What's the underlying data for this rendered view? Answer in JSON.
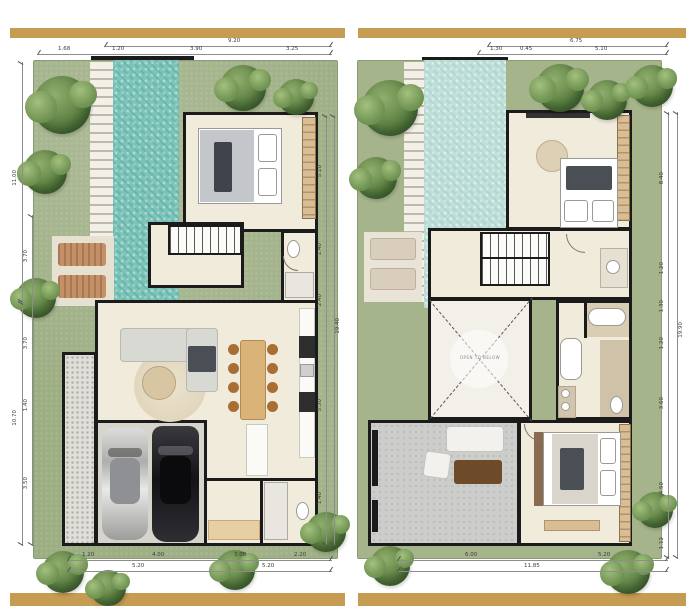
{
  "meta": {
    "description": "Two-storey villa floor plans with lap pool — ground floor (left) and upper floor (right)"
  },
  "colors": {
    "accent_gold": "#c69b52",
    "pool": "#7cc4b9",
    "pool_below": "#bfe0d9",
    "lawn": "#9dae83",
    "wall": "#1b1b1b",
    "floor": "#f1ebdc"
  },
  "labels": {
    "void": "OPEN TO BELOW"
  },
  "plans": [
    {
      "name": "Ground Floor",
      "dims": {
        "top": {
          "overall": "9.20",
          "segments": [
            "1.68",
            "1.20",
            "3.90",
            "3.25"
          ]
        },
        "left": {
          "overall_upper": "11.00",
          "overall_lower": "10.70",
          "segments": [
            "3.70",
            "3.70",
            "1.40",
            "3.50"
          ]
        },
        "right": {
          "overall": "19.40",
          "segments": [
            "5.10",
            "1.40",
            "2.40",
            "5.30",
            "1.40"
          ]
        },
        "bottom": {
          "row1": [
            "1.20",
            "4.00",
            "3.00",
            "2.20"
          ],
          "row2": [
            "5.20",
            "5.20"
          ]
        }
      }
    },
    {
      "name": "Upper Floor",
      "dims": {
        "top": {
          "overall": "6.75",
          "segments": [
            "1.30",
            "0.45",
            "5.10"
          ]
        },
        "right": {
          "overall": "19.90",
          "segments": [
            "8.40",
            "1.20",
            "1.30",
            "1.20",
            "3.60",
            "4.50",
            "1.12"
          ]
        },
        "bottom": {
          "overall": "11.85",
          "segments": [
            "6.00",
            "5.20"
          ]
        }
      }
    }
  ]
}
